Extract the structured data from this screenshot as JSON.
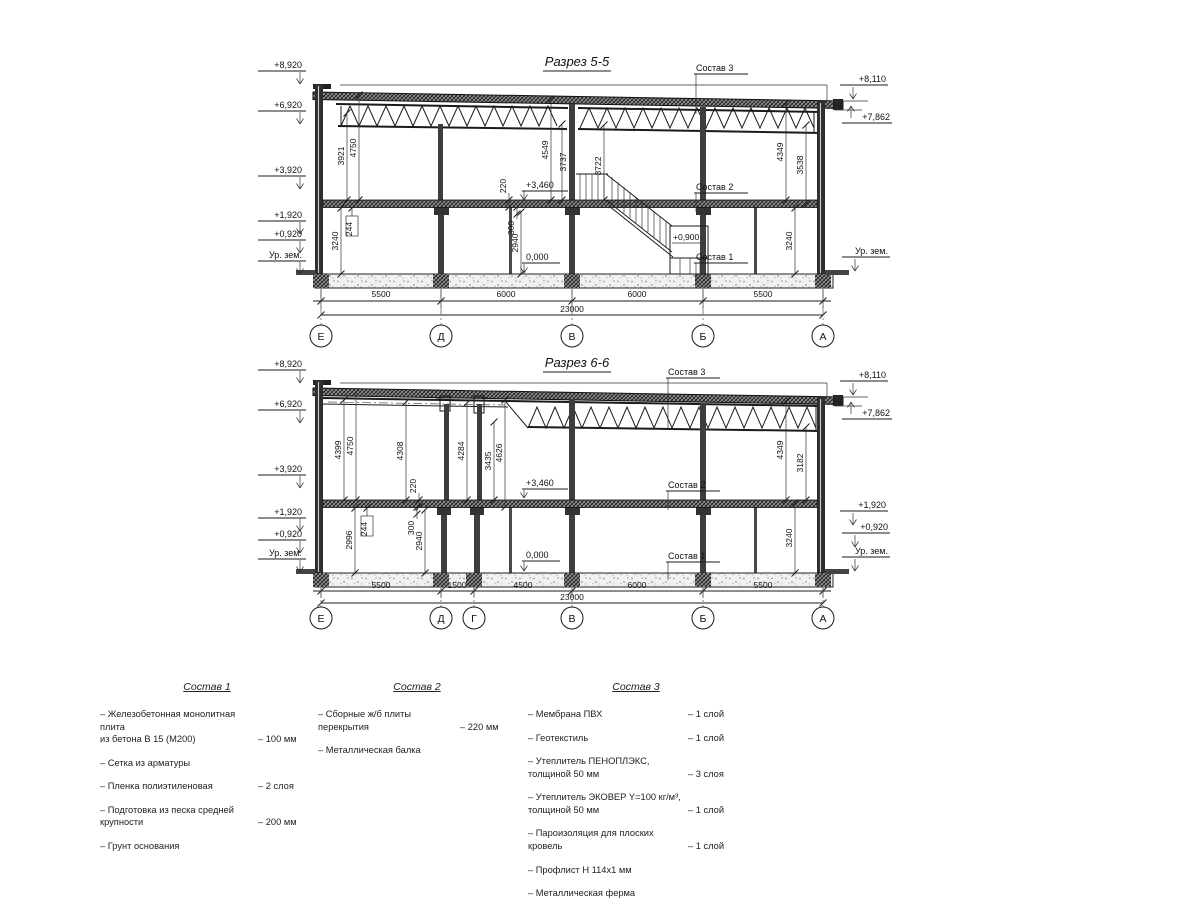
{
  "s55": {
    "title": "Разрез 5-5",
    "left_marks": [
      "+8,920",
      "+6,920",
      "+3,920",
      "+1,920",
      "+0,920",
      "Ур. зем."
    ],
    "right_marks": [
      "+8,110",
      "+7,862",
      "Ур. зем."
    ],
    "callouts": [
      "Состав 3",
      "Состав 2",
      "Состав 1"
    ],
    "levels": {
      "mid": "+3,460",
      "zero": "0,000",
      "stair": "+0,900"
    },
    "vdims": [
      "3921",
      "4750",
      "4549",
      "3737",
      "3722",
      "4349",
      "3538",
      "3240",
      "2940",
      "3240",
      "220",
      "300",
      "244"
    ],
    "bottom_dims": [
      "5500",
      "6000",
      "6000",
      "5500"
    ],
    "total": "23000",
    "axes": [
      "Е",
      "Д",
      "В",
      "Б",
      "А"
    ]
  },
  "s66": {
    "title": "Разрез 6-6",
    "left_marks": [
      "+8,920",
      "+6,920",
      "+3,920",
      "+1,920",
      "+0,920",
      "Ур. зем."
    ],
    "right_marks": [
      "+8,110",
      "+7,862",
      "+1,920",
      "+0,920",
      "Ур. зем."
    ],
    "callouts": [
      "Состав 3",
      "Состав 2",
      "Состав 1"
    ],
    "levels": {
      "mid": "+3,460",
      "zero": "0,000"
    },
    "vdims": [
      "4399",
      "4750",
      "4308",
      "4284",
      "3435",
      "4626",
      "2996",
      "2940",
      "4349",
      "3182",
      "3240",
      "220",
      "300",
      "244"
    ],
    "bottom_dims": [
      "5500",
      "1500",
      "4500",
      "6000",
      "5500"
    ],
    "total": "23000",
    "axes": [
      "Е",
      "Д",
      "Г",
      "В",
      "Б",
      "А"
    ]
  },
  "legend": {
    "c1": {
      "title": "Состав 1",
      "items": [
        {
          "n": "– Железобетонная  монолитная плита\nиз бетона В 15 (М200)",
          "v": "– 100 мм"
        },
        {
          "n": "– Сетка из арматуры",
          "v": ""
        },
        {
          "n": "– Пленка полиэтиленовая",
          "v": "– 2 слоя"
        },
        {
          "n": "– Подготовка из песка средней\nкрупности",
          "v": "– 200 мм"
        },
        {
          "n": "– Грунт основания",
          "v": ""
        }
      ]
    },
    "c2": {
      "title": "Состав 2",
      "items": [
        {
          "n": "– Сборные ж/б плиты перекрытия",
          "v": "– 220 мм"
        },
        {
          "n": "– Металлическая балка",
          "v": ""
        }
      ]
    },
    "c3": {
      "title": "Состав 3",
      "items": [
        {
          "n": "– Мембрана ПВХ",
          "v": "– 1 слой"
        },
        {
          "n": "– Геотекстиль",
          "v": "– 1 слой"
        },
        {
          "n": "– Утеплитель ПЕНОПЛЭКС,\nтолщиной 50 мм",
          "v": "– 3 слоя"
        },
        {
          "n": "– Утеплитель ЭКОВЕР Y=100 кг/м³,\nтолщиной 50 мм",
          "v": "– 1 слой"
        },
        {
          "n": "– Пароизоляция для плоских кровель",
          "v": "– 1 слой"
        },
        {
          "n": "– Профлист Н 114х1 мм",
          "v": ""
        },
        {
          "n": "– Металлическая ферма\n(с торца металлическая балка)",
          "v": ""
        }
      ]
    }
  }
}
